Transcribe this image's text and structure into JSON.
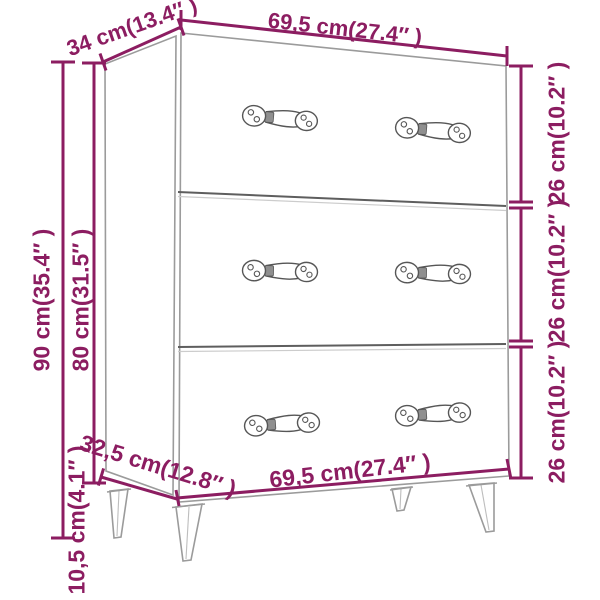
{
  "figure": {
    "kind": "furniture dimension line drawing",
    "item": "chest of drawers",
    "drawer_count": 3,
    "handles_per_drawer": 2,
    "leg_count": 4
  },
  "labels": {
    "top_depth": "34 cm(13.4″ )",
    "top_width": "69,5 cm(27.4″ )",
    "side_total_height": "90 cm(35.4″ )",
    "side_body_height": "80 cm(31.5″ )",
    "side_leg_height": "10,5 cm(4.1″ )",
    "drawer1_height": "26 cm(10.2″ )",
    "drawer2_height": "26 cm(10.2″ )",
    "drawer3_height": "26 cm(10.2″ )",
    "bottom_width": "69,5 cm(27.4″ )",
    "bottom_depth": "32,5 cm(12.8″ )"
  },
  "measurements_cm": {
    "width": 69.5,
    "depth_top": 34,
    "depth_bottom": 32.5,
    "height_total": 90,
    "height_body": 80,
    "leg_height": 10.5,
    "drawer_front_height": 26
  },
  "measurements_in": {
    "width": 27.4,
    "depth_top": 13.4,
    "depth_bottom": 12.8,
    "height_total": 35.4,
    "height_body": 31.5,
    "leg_height": 4.1,
    "drawer_front_height": 10.2
  },
  "colors": {
    "dimension": "#8c1d61",
    "outline": "#9b9b9b",
    "divider": "#5e5e5e",
    "handle": "#565656",
    "background": "#ffffff"
  }
}
